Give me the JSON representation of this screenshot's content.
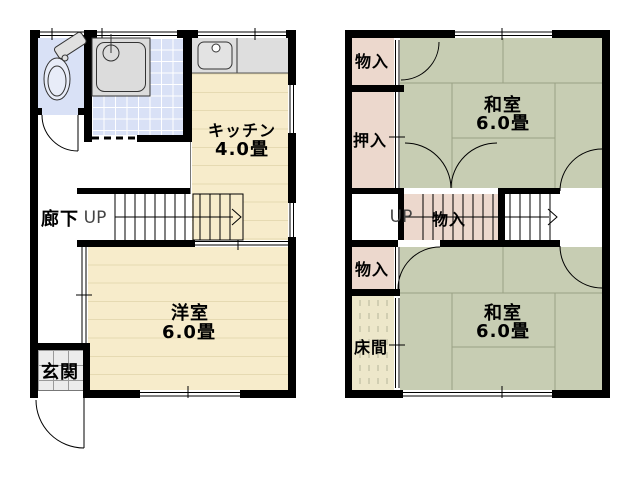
{
  "first_floor": {
    "kitchen_label": "キッチン",
    "kitchen_size": "4.0畳",
    "hallway_label": "廊下",
    "up_label": "UP",
    "western_room_label": "洋室",
    "western_room_size": "6.0畳",
    "entrance_label": "玄関"
  },
  "second_floor": {
    "storage_top_label": "物入",
    "closet_label": "押入",
    "tatami_upper_label": "和室",
    "tatami_upper_size": "6.0畳",
    "up_label": "UP",
    "storage_mid_label": "物入",
    "storage_bottom_label": "物入",
    "tokonoma_label": "床間",
    "tatami_lower_label": "和室",
    "tatami_lower_size": "6.0畳"
  },
  "colors": {
    "wall": "#000000",
    "tatami_green": "#c7cdb3",
    "flooring_cream": "#f7eccb",
    "wet_area_blue": "#d9e1f6",
    "storage_pink": "#ecd8cd",
    "tokonoma_beige": "#ede7ca",
    "entrance_tile_gray": "#ececec",
    "counter_gray": "#dedede"
  }
}
